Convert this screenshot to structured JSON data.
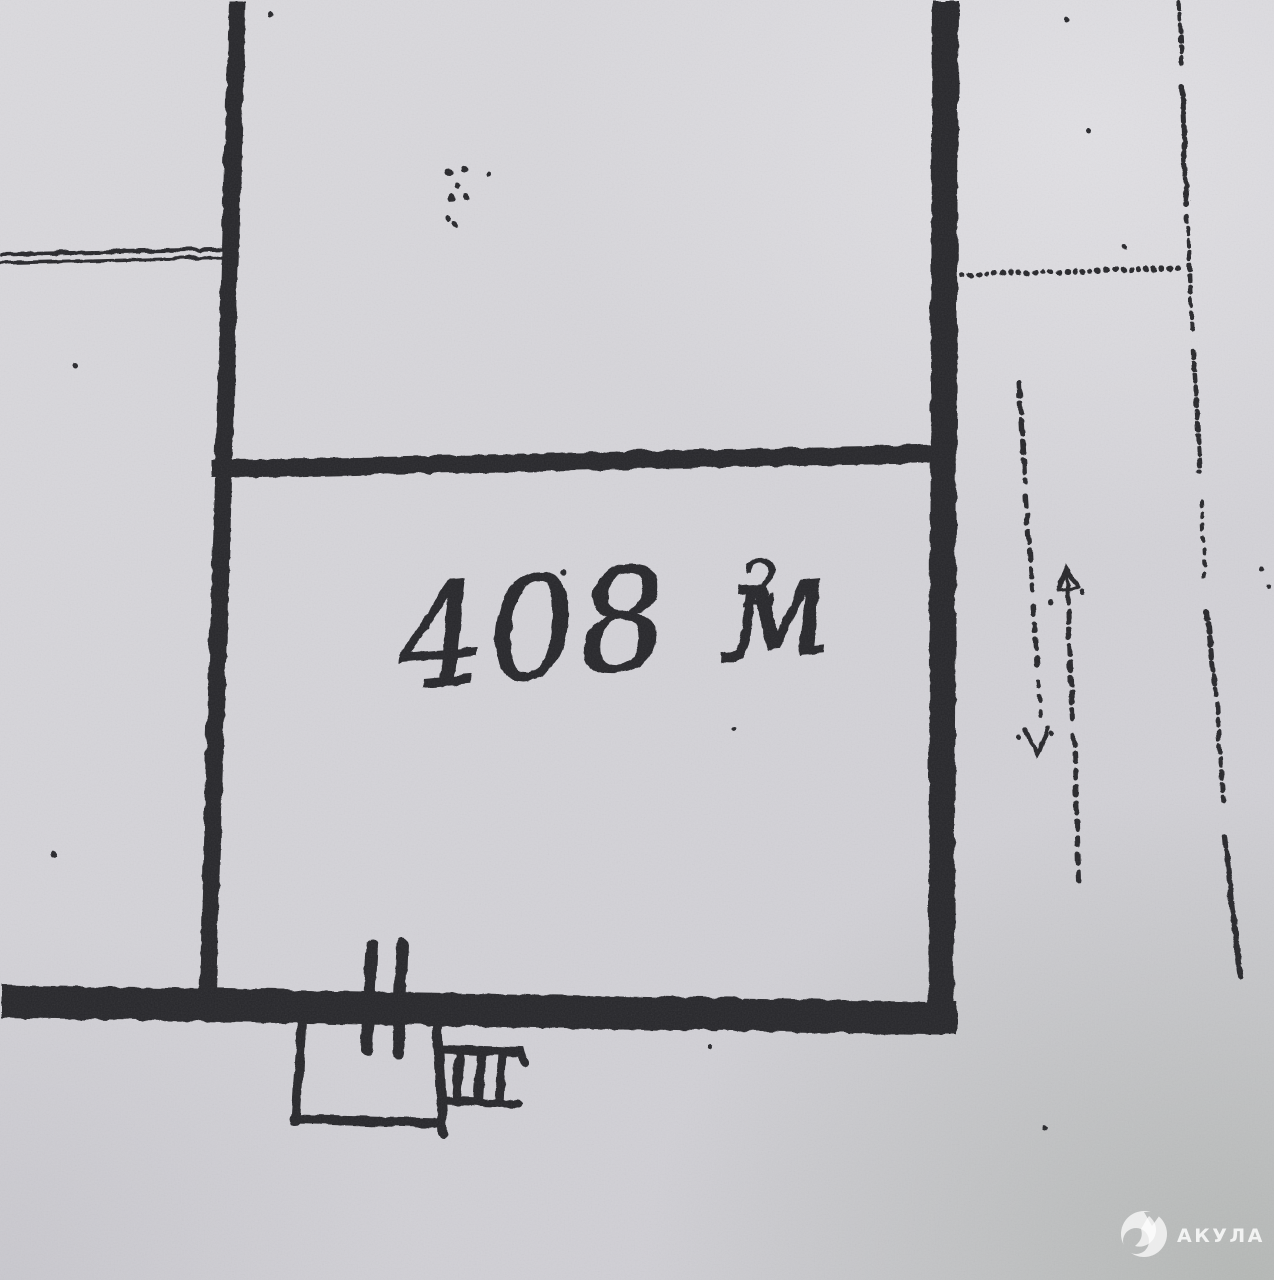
{
  "plan": {
    "area_annotation": {
      "text": "408 м",
      "superscript": "2",
      "full_label": "408 м²"
    },
    "ink_color": "#26262b",
    "paper_color": "#d5d4d9"
  },
  "watermark": {
    "brand": "АКУЛА",
    "icon": "shark-logo-icon",
    "color": "#ffffff"
  }
}
